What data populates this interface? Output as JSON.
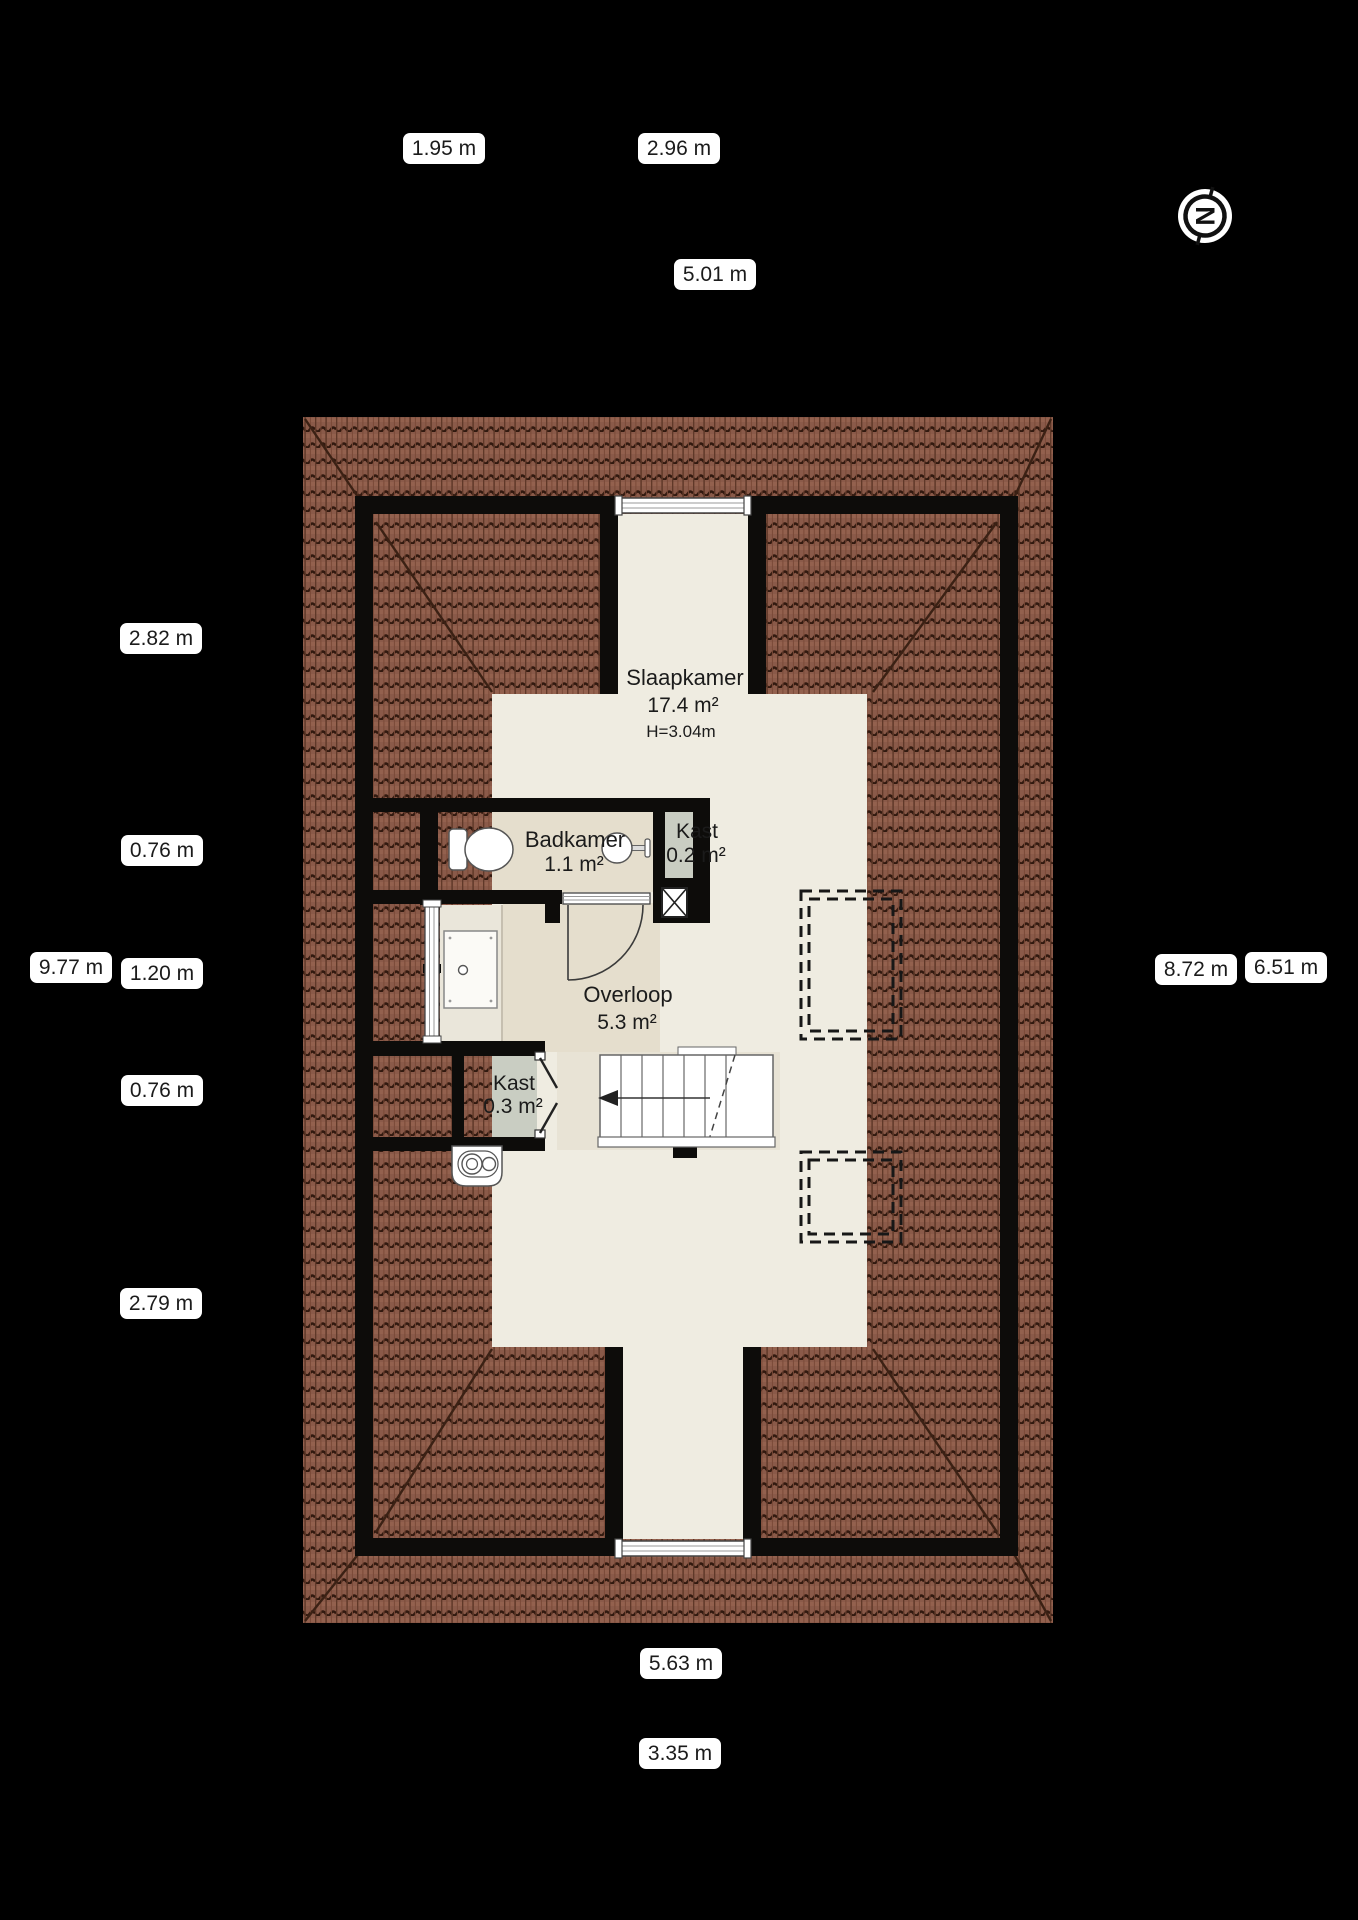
{
  "title": "Floor plan - attic storey (zolder)",
  "compass": {
    "letter": "N"
  },
  "rooms": {
    "slaapkamer": {
      "name": "Slaapkamer",
      "area": "17.4 m²",
      "height": "H=3.04m"
    },
    "badkamer": {
      "name": "Badkamer",
      "area": "1.1 m²"
    },
    "kast_klein": {
      "name": "Kast",
      "area": "0.2 m²"
    },
    "overloop": {
      "name": "Overloop",
      "area": "5.3 m²"
    },
    "kast_groot": {
      "name": "Kast",
      "area": "0.3 m²"
    }
  },
  "dimensions": {
    "top_left": "1.95 m",
    "top_right": "2.96 m",
    "top_total": "5.01 m",
    "left_1": "2.82 m",
    "left_2": "0.76 m",
    "left_total": "9.77 m",
    "left_3": "1.20 m",
    "left_4": "0.76 m",
    "left_5": "2.79 m",
    "right_total": "8.72 m",
    "right_inner": "6.51 m",
    "bottom_total": "5.63 m",
    "bottom_inner": "3.35 m"
  },
  "colors": {
    "background": "#000000",
    "roof_tile": "#8a5a49",
    "roof_line": "#31190f",
    "wall": "#0d0c0a",
    "floor_light": "#efece1",
    "floor_tan": "#e5decd",
    "closet_floor": "#c9cdc2",
    "label_bg": "#ffffff",
    "label_text": "#1b1b1b"
  }
}
